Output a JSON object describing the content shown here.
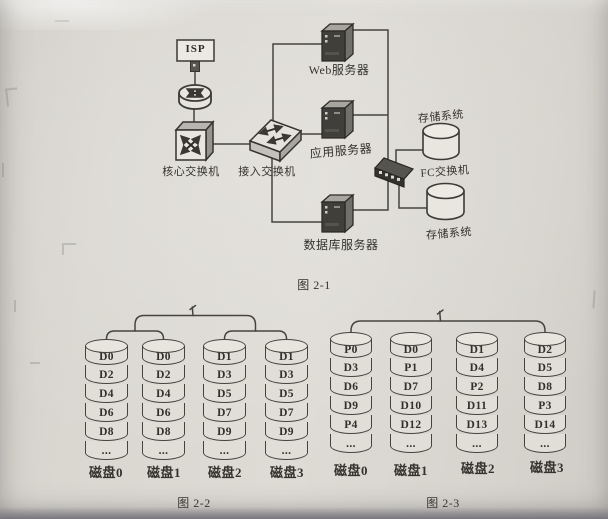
{
  "figure1": {
    "caption": "图 2-1",
    "labels": {
      "isp": "ISP",
      "core_switch": "核心交换机",
      "access_switch": "接入交换机",
      "web_server": "Web服务器",
      "app_server": "应用服务器",
      "db_server": "数据库服务器",
      "fc_switch": "FC交换机",
      "storage_top": "存储系统",
      "storage_bottom": "存储系统"
    },
    "icons": [
      "isp-box",
      "uplink-connector-icon",
      "router-icon",
      "core-switch-icon",
      "access-switch-icon",
      "server-tower-icon",
      "fc-switch-icon",
      "storage-cylinder-icon"
    ]
  },
  "figure2": {
    "caption": "图 2-2",
    "disks": [
      {
        "label": "磁盘0",
        "blocks": [
          "D0",
          "D2",
          "D4",
          "D6",
          "D8",
          "..."
        ]
      },
      {
        "label": "磁盘1",
        "blocks": [
          "D0",
          "D2",
          "D4",
          "D6",
          "D8",
          "..."
        ]
      },
      {
        "label": "磁盘2",
        "blocks": [
          "D1",
          "D3",
          "D5",
          "D7",
          "D9",
          "..."
        ]
      },
      {
        "label": "磁盘3",
        "blocks": [
          "D1",
          "D3",
          "D5",
          "D7",
          "D9",
          "..."
        ]
      }
    ]
  },
  "figure3": {
    "caption": "图 2-3",
    "disks": [
      {
        "label": "磁盘0",
        "blocks": [
          "P0",
          "D3",
          "D6",
          "D9",
          "P4",
          "..."
        ]
      },
      {
        "label": "磁盘1",
        "blocks": [
          "D0",
          "P1",
          "D7",
          "D10",
          "D12",
          "..."
        ]
      },
      {
        "label": "磁盘2",
        "blocks": [
          "D1",
          "D4",
          "P2",
          "D11",
          "D13",
          "..."
        ]
      },
      {
        "label": "磁盘3",
        "blocks": [
          "D2",
          "D5",
          "D8",
          "P3",
          "D14",
          "..."
        ]
      }
    ]
  },
  "colors": {
    "ink": "#45433d",
    "paper": "#d8d5cf",
    "server_front": "#403f3b",
    "cell_fill": "#e1ded7"
  }
}
